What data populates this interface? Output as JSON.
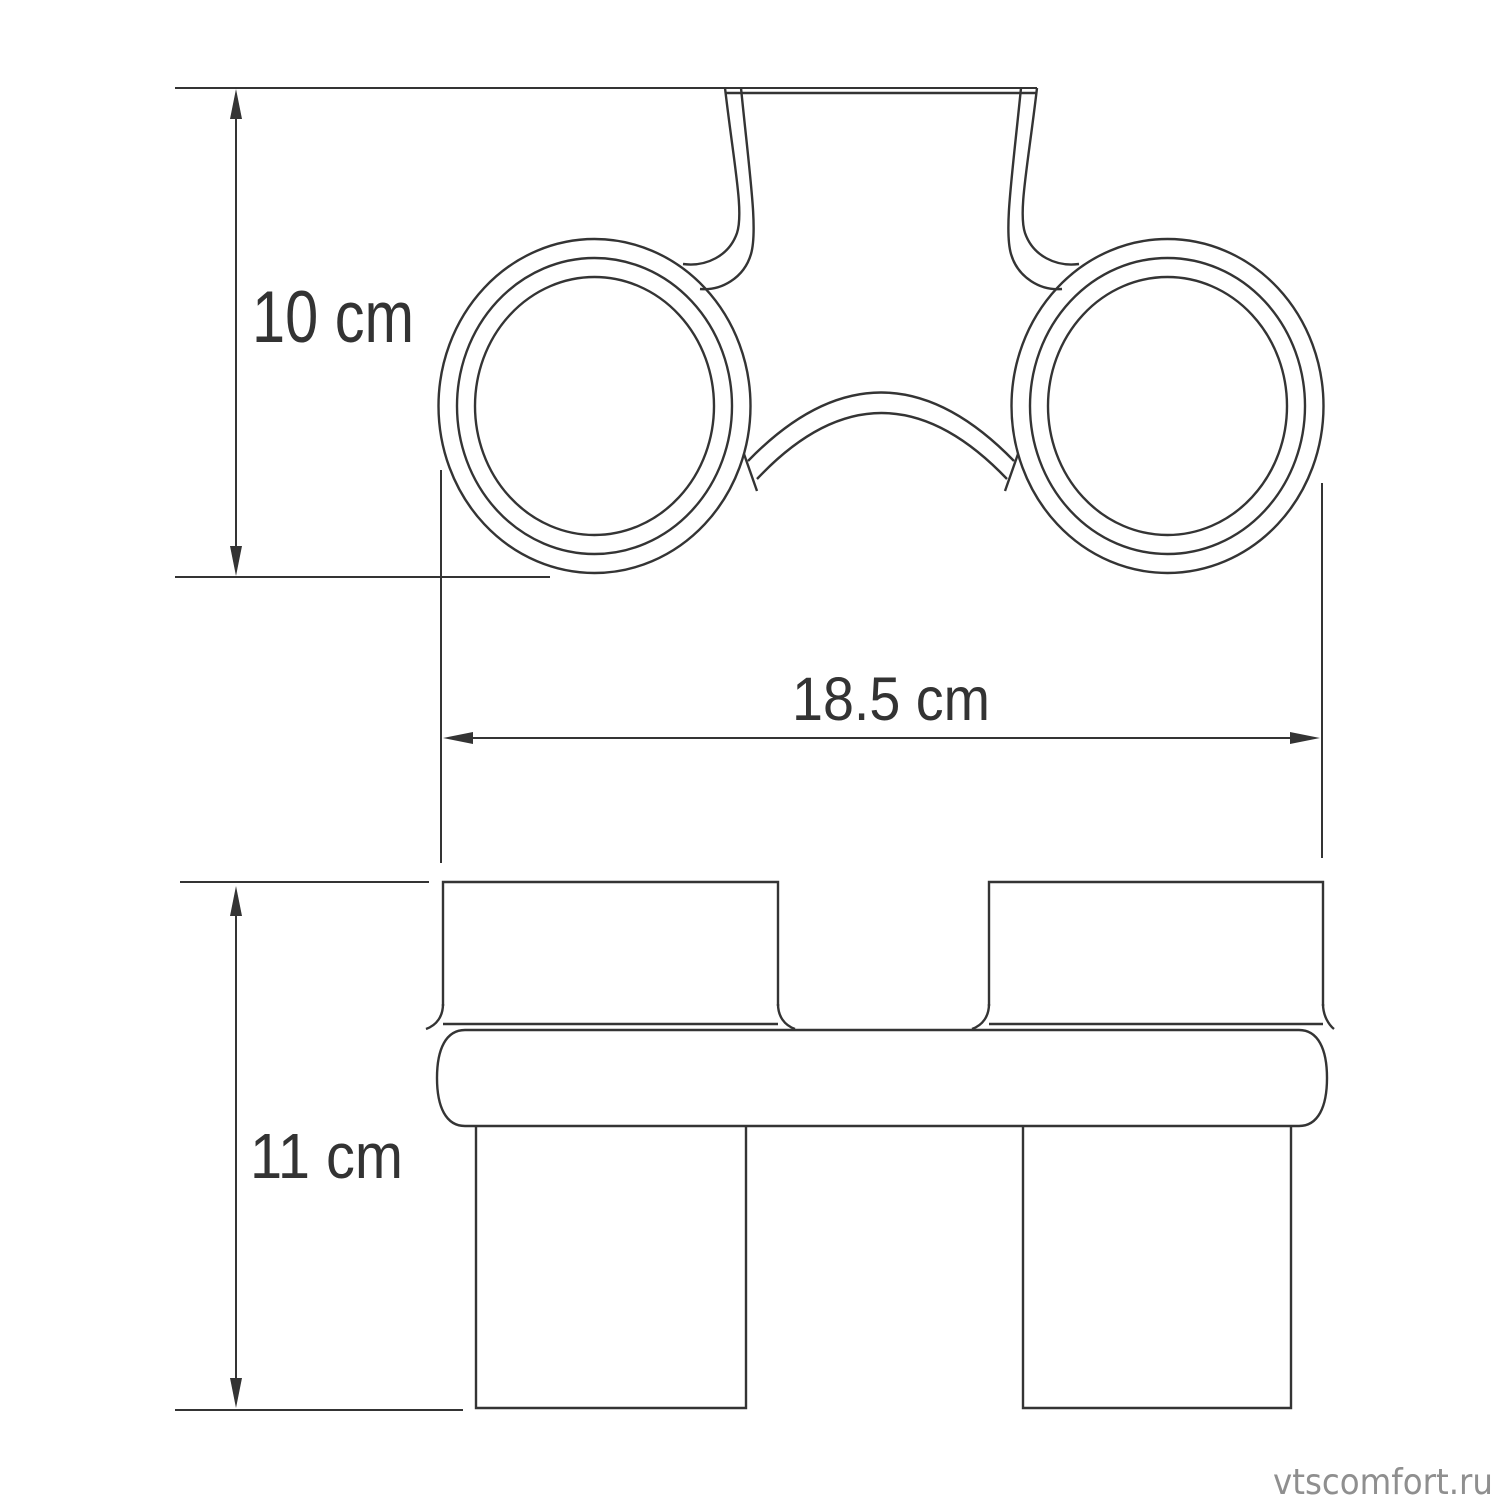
{
  "colors": {
    "background": "#ffffff",
    "line": "#343434",
    "text": "#333333",
    "watermark": "#8f8f8f"
  },
  "diagram": {
    "type": "technical-dimension-drawing",
    "views": {
      "top": {
        "name": "top view — wall plate with two holder rings"
      },
      "front": {
        "name": "front view — two glasses in holder bar"
      }
    },
    "dimensions": {
      "depth": {
        "label": "10 cm",
        "orientation": "vertical",
        "view": "top"
      },
      "width": {
        "label": "18.5 cm",
        "orientation": "horizontal",
        "view": "top"
      },
      "height": {
        "label": "11 cm",
        "orientation": "vertical",
        "view": "front"
      }
    },
    "watermark": {
      "text": "vtscomfort.ru"
    }
  }
}
